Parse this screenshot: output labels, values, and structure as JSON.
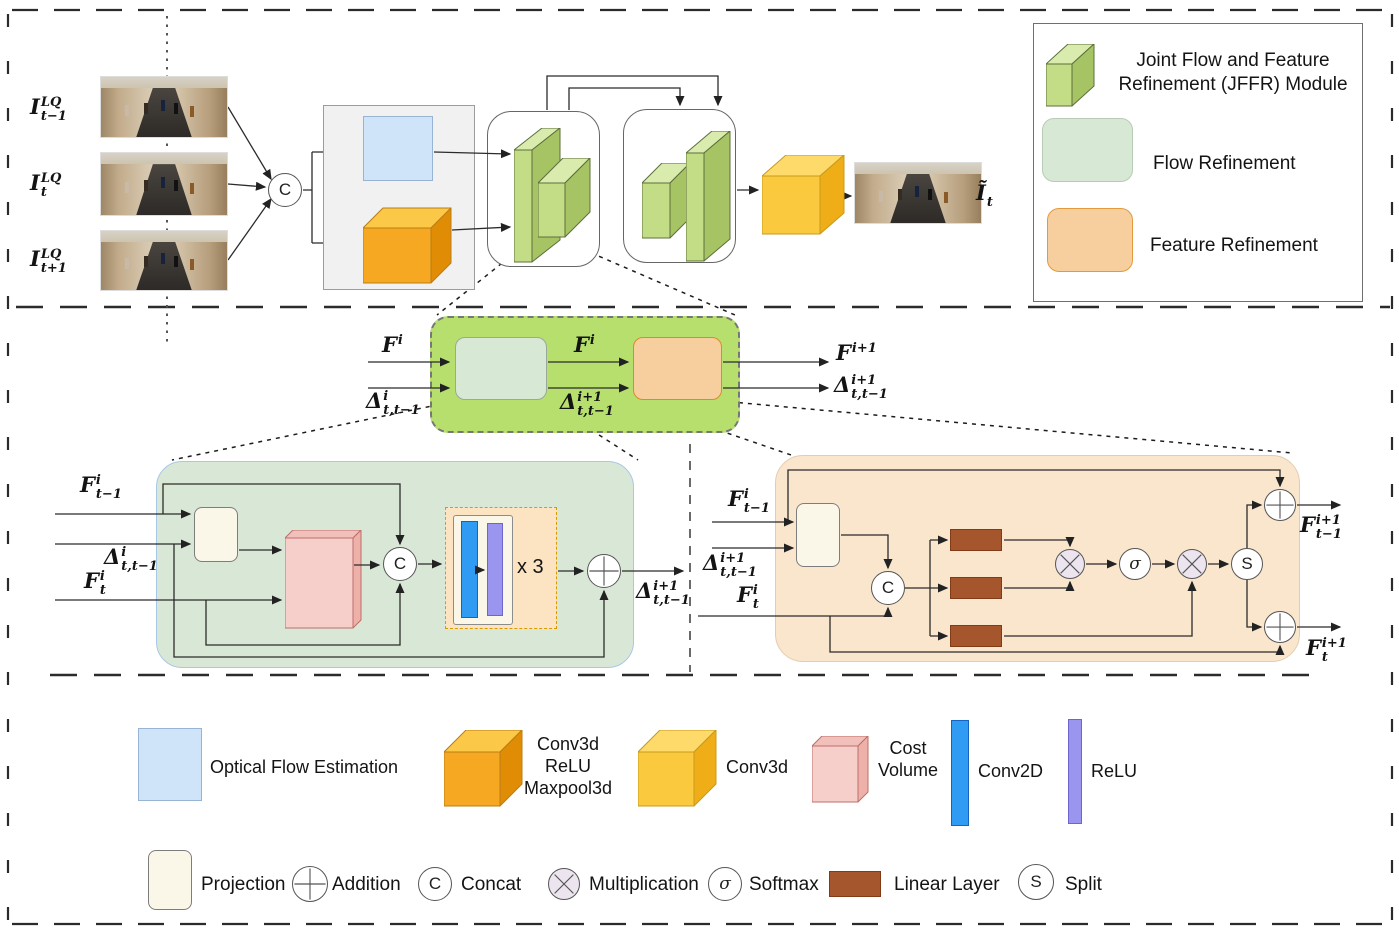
{
  "colors": {
    "jffr-box-green": "#b7df6e",
    "flow-green": "#d7e8d4",
    "feature-orange": "#f7cf9e",
    "slab-front": "#c3dd86",
    "slab-top": "#d9ebad",
    "slab-side": "#a6c464",
    "cube-orange-front": "#f7a823",
    "cube-orange-top": "#fcc848",
    "cube-orange-side": "#e08c05",
    "cube-yellow-front": "#fbc93d",
    "cube-yellow-top": "#fdda6a",
    "cube-yellow-side": "#efad18",
    "cost-pink-front": "#f6cfca",
    "cost-pink-top": "#f2c0ba",
    "cost-pink-side": "#eeb1aa",
    "optical-blue": "#cfe4f8",
    "conv2d-blue": "#2f9bf2",
    "relu-purple": "#9a95ef",
    "linear-brown": "#a5562c",
    "projection-cream": "#fbf7e8",
    "gray-panel": "#f1f1f1",
    "mult-fill": "#ece4ee",
    "flow-detail-bg": "#d9e8d6",
    "feature-detail-bg": "#f9e6cc"
  },
  "top_section": {
    "inputs": [
      {
        "b": "I",
        "sup": "LQ",
        "sub": "t−1"
      },
      {
        "b": "I",
        "sup": "LQ",
        "sub": "t"
      },
      {
        "b": "I",
        "sup": "LQ",
        "sub": "t+1"
      }
    ],
    "concat": "C",
    "output": {
      "b": "Ĩ",
      "sup": "",
      "sub": "t"
    }
  },
  "jffr_overview": {
    "in_f": {
      "b": "F",
      "sup": "i",
      "sub": ""
    },
    "in_d": {
      "b": "Δ",
      "sup": "i",
      "sub": "t,t−1"
    },
    "mid_f": {
      "b": "F",
      "sup": "i",
      "sub": ""
    },
    "mid_d": {
      "b": "Δ",
      "sup": "i+1",
      "sub": "t,t−1"
    },
    "out_f": {
      "b": "F",
      "sup": "i+1",
      "sub": ""
    },
    "out_d": {
      "b": "Δ",
      "sup": "i+1",
      "sub": "t,t−1"
    }
  },
  "flow_refinement": {
    "in1": {
      "b": "F",
      "sup": "i",
      "sub": "t−1"
    },
    "in2": {
      "b": "Δ",
      "sup": "i",
      "sub": "t,t−1"
    },
    "in3": {
      "b": "F",
      "sup": "i",
      "sub": "t"
    },
    "concat": "C",
    "repeat": "x 3",
    "out": {
      "b": "Δ",
      "sup": "i+1",
      "sub": "t,t−1"
    }
  },
  "feature_refinement": {
    "in1": {
      "b": "F",
      "sup": "i",
      "sub": "t−1"
    },
    "in2": {
      "b": "Δ",
      "sup": "i+1",
      "sub": "t,t−1"
    },
    "in3": {
      "b": "F",
      "sup": "i",
      "sub": "t"
    },
    "concat": "C",
    "softmax": "σ",
    "split": "S",
    "out1": {
      "b": "F",
      "sup": "i+1",
      "sub": "t−1"
    },
    "out2": {
      "b": "F",
      "sup": "i+1",
      "sub": "t"
    }
  },
  "legend_box": {
    "jffr_lines": [
      "Joint Flow and Feature",
      "Refinement (JFFR) Module"
    ],
    "flow": "Flow Refinement",
    "feature": "Feature Refinement"
  },
  "bottom_legend": {
    "row1": [
      {
        "label": "Optical Flow Estimation"
      },
      {
        "label_lines": [
          "Conv3d",
          "ReLU",
          "Maxpool3d"
        ]
      },
      {
        "label": "Conv3d"
      },
      {
        "label_lines": [
          "Cost",
          "Volume"
        ]
      },
      {
        "label": "Conv2D"
      },
      {
        "label": "ReLU"
      }
    ],
    "row2": [
      {
        "symbol": "",
        "label": "Projection"
      },
      {
        "symbol": "+",
        "label": "Addition"
      },
      {
        "symbol": "C",
        "label": "Concat"
      },
      {
        "symbol": "×",
        "label": "Multiplication"
      },
      {
        "symbol": "σ",
        "label": "Softmax"
      },
      {
        "symbol": "",
        "label": "Linear Layer"
      },
      {
        "symbol": "S",
        "label": "Split"
      }
    ]
  }
}
